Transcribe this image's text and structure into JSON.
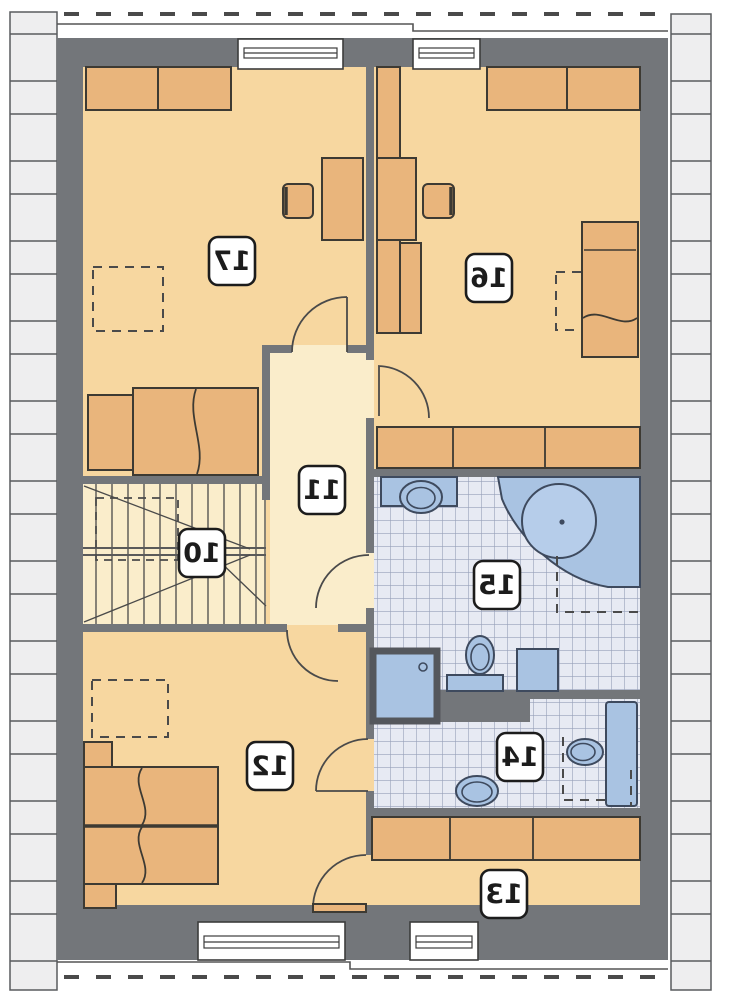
{
  "floor_plan": {
    "room_labels": [
      {
        "number": "10"
      },
      {
        "number": "11"
      },
      {
        "number": "12"
      },
      {
        "number": "13"
      },
      {
        "number": "14"
      },
      {
        "number": "15"
      },
      {
        "number": "16"
      },
      {
        "number": "17"
      }
    ],
    "colors": {
      "wall": "#73767a",
      "room_floor": "#f7d7a0",
      "hallway_floor": "#faedcb",
      "furniture": "#e9b57c",
      "outline": "#3d3a33",
      "fixture_fill": "#a9c3e2",
      "fixture_line": "#3e4a5e",
      "tile_fill": "#e7eaf3",
      "tile_line": "#97a0ba",
      "brick_fill": "#eeeeef",
      "brick_line": "#595b5e",
      "line": "#4a4a4a",
      "label_text": "#1c1c1c"
    }
  }
}
